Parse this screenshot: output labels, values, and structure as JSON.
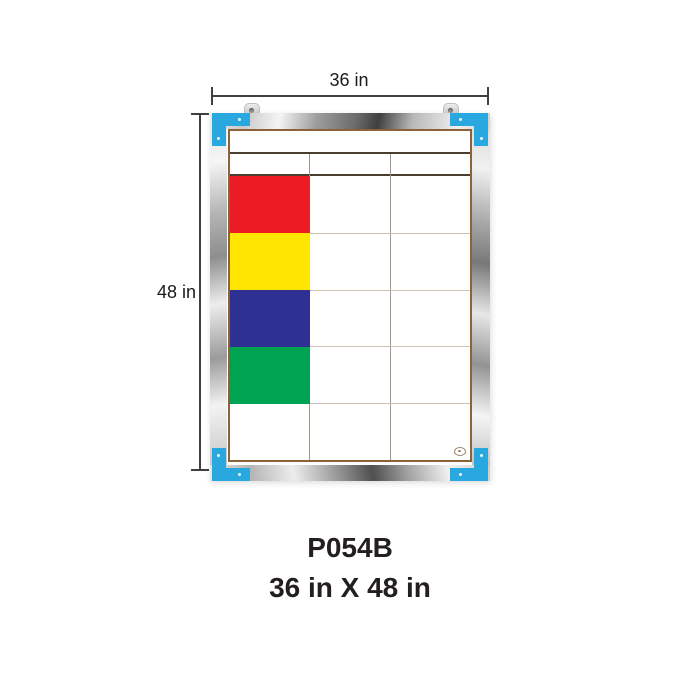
{
  "annotations": {
    "width_label": "36 in",
    "height_label": "48 in"
  },
  "caption": {
    "model": "P054B",
    "size": "36 in X 48 in"
  },
  "board": {
    "frame_material": "silver",
    "hanger_count": 2,
    "grid": {
      "columns": 3,
      "header_rows": 2,
      "body_rows": 5,
      "legend_cells": [
        {
          "row": 1,
          "column": 1,
          "name": "red",
          "color": "#EC1C24"
        },
        {
          "row": 2,
          "column": 1,
          "name": "yellow",
          "color": "#FFE600"
        },
        {
          "row": 3,
          "column": 1,
          "name": "navy",
          "color": "#2E3192"
        },
        {
          "row": 4,
          "column": 1,
          "name": "green",
          "color": "#00A351"
        }
      ]
    }
  },
  "icons": {
    "hanger": "keyhole-hanger",
    "screw": "screw-dot",
    "brand": "brand-oval-mark"
  },
  "colors": {
    "corner_blue": "#29A8DF",
    "grid_border_brown": "#8C6239",
    "header_line_dark": "#4A3E30",
    "grid_line_light": "#CFC1B1",
    "grid_line_vertical": "#A5947F",
    "dimension_line": "#404040",
    "caption_text": "#231F20"
  }
}
